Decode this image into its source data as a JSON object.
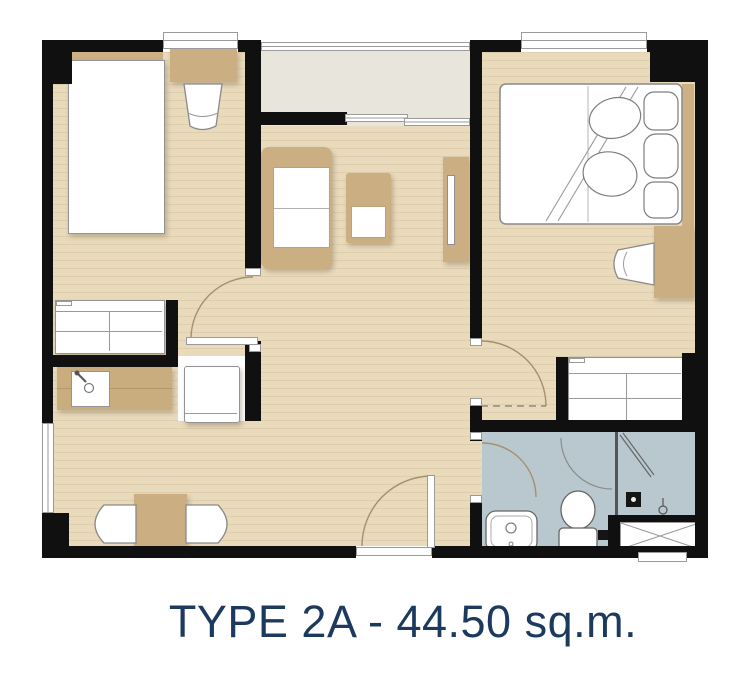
{
  "caption": {
    "text": "TYPE 2A - 44.50 sq.m.",
    "unit_type": "TYPE 2A",
    "area": "44.50 sq.m."
  },
  "palette": {
    "wall": "#101010",
    "floor": "#e9dabc",
    "balcony": "#e8e5dc",
    "bathroom": "#b9c8ce",
    "tan": "#cbae81",
    "tan-head": "#cdb185",
    "counter": "#c9ad7f",
    "outline": "#8a8a8a",
    "arc": "#a5906c",
    "title": "#1c3a5e",
    "canvas": "#ffffff"
  },
  "floorplan": {
    "rooms": [
      {
        "name": "bedroom-1",
        "position": "top-left",
        "furniture": [
          "single-bed",
          "headboard",
          "desk",
          "chair",
          "wardrobe"
        ]
      },
      {
        "name": "living-room",
        "position": "center",
        "furniture": [
          "sofa",
          "coffee-table",
          "tv-console"
        ]
      },
      {
        "name": "bedroom-2",
        "position": "top-right",
        "furniture": [
          "double-bed",
          "pillows",
          "headboard",
          "desk",
          "chair",
          "wardrobe"
        ]
      },
      {
        "name": "kitchen-dining",
        "position": "bottom-left",
        "furniture": [
          "kitchen-counter",
          "sink",
          "refrigerator",
          "dining-table",
          "dining-chair",
          "dining-chair"
        ]
      },
      {
        "name": "bathroom",
        "position": "bottom-right",
        "furniture": [
          "washbasin",
          "toilet",
          "shower-enclosure",
          "shower-mixer",
          "floor-drain"
        ]
      },
      {
        "name": "balcony",
        "position": "top-center",
        "furniture": [
          "railing",
          "sliding-door"
        ]
      },
      {
        "name": "ac-ledge",
        "position": "bottom-right-corner",
        "furniture": [
          "condenser-unit"
        ]
      }
    ],
    "doors": [
      "bedroom-1-door",
      "bedroom-2-door",
      "bathroom-door",
      "entrance-door",
      "shower-door"
    ],
    "windows": [
      "bedroom-1-window",
      "bedroom-2-window",
      "dining-window",
      "balcony-railing"
    ]
  }
}
